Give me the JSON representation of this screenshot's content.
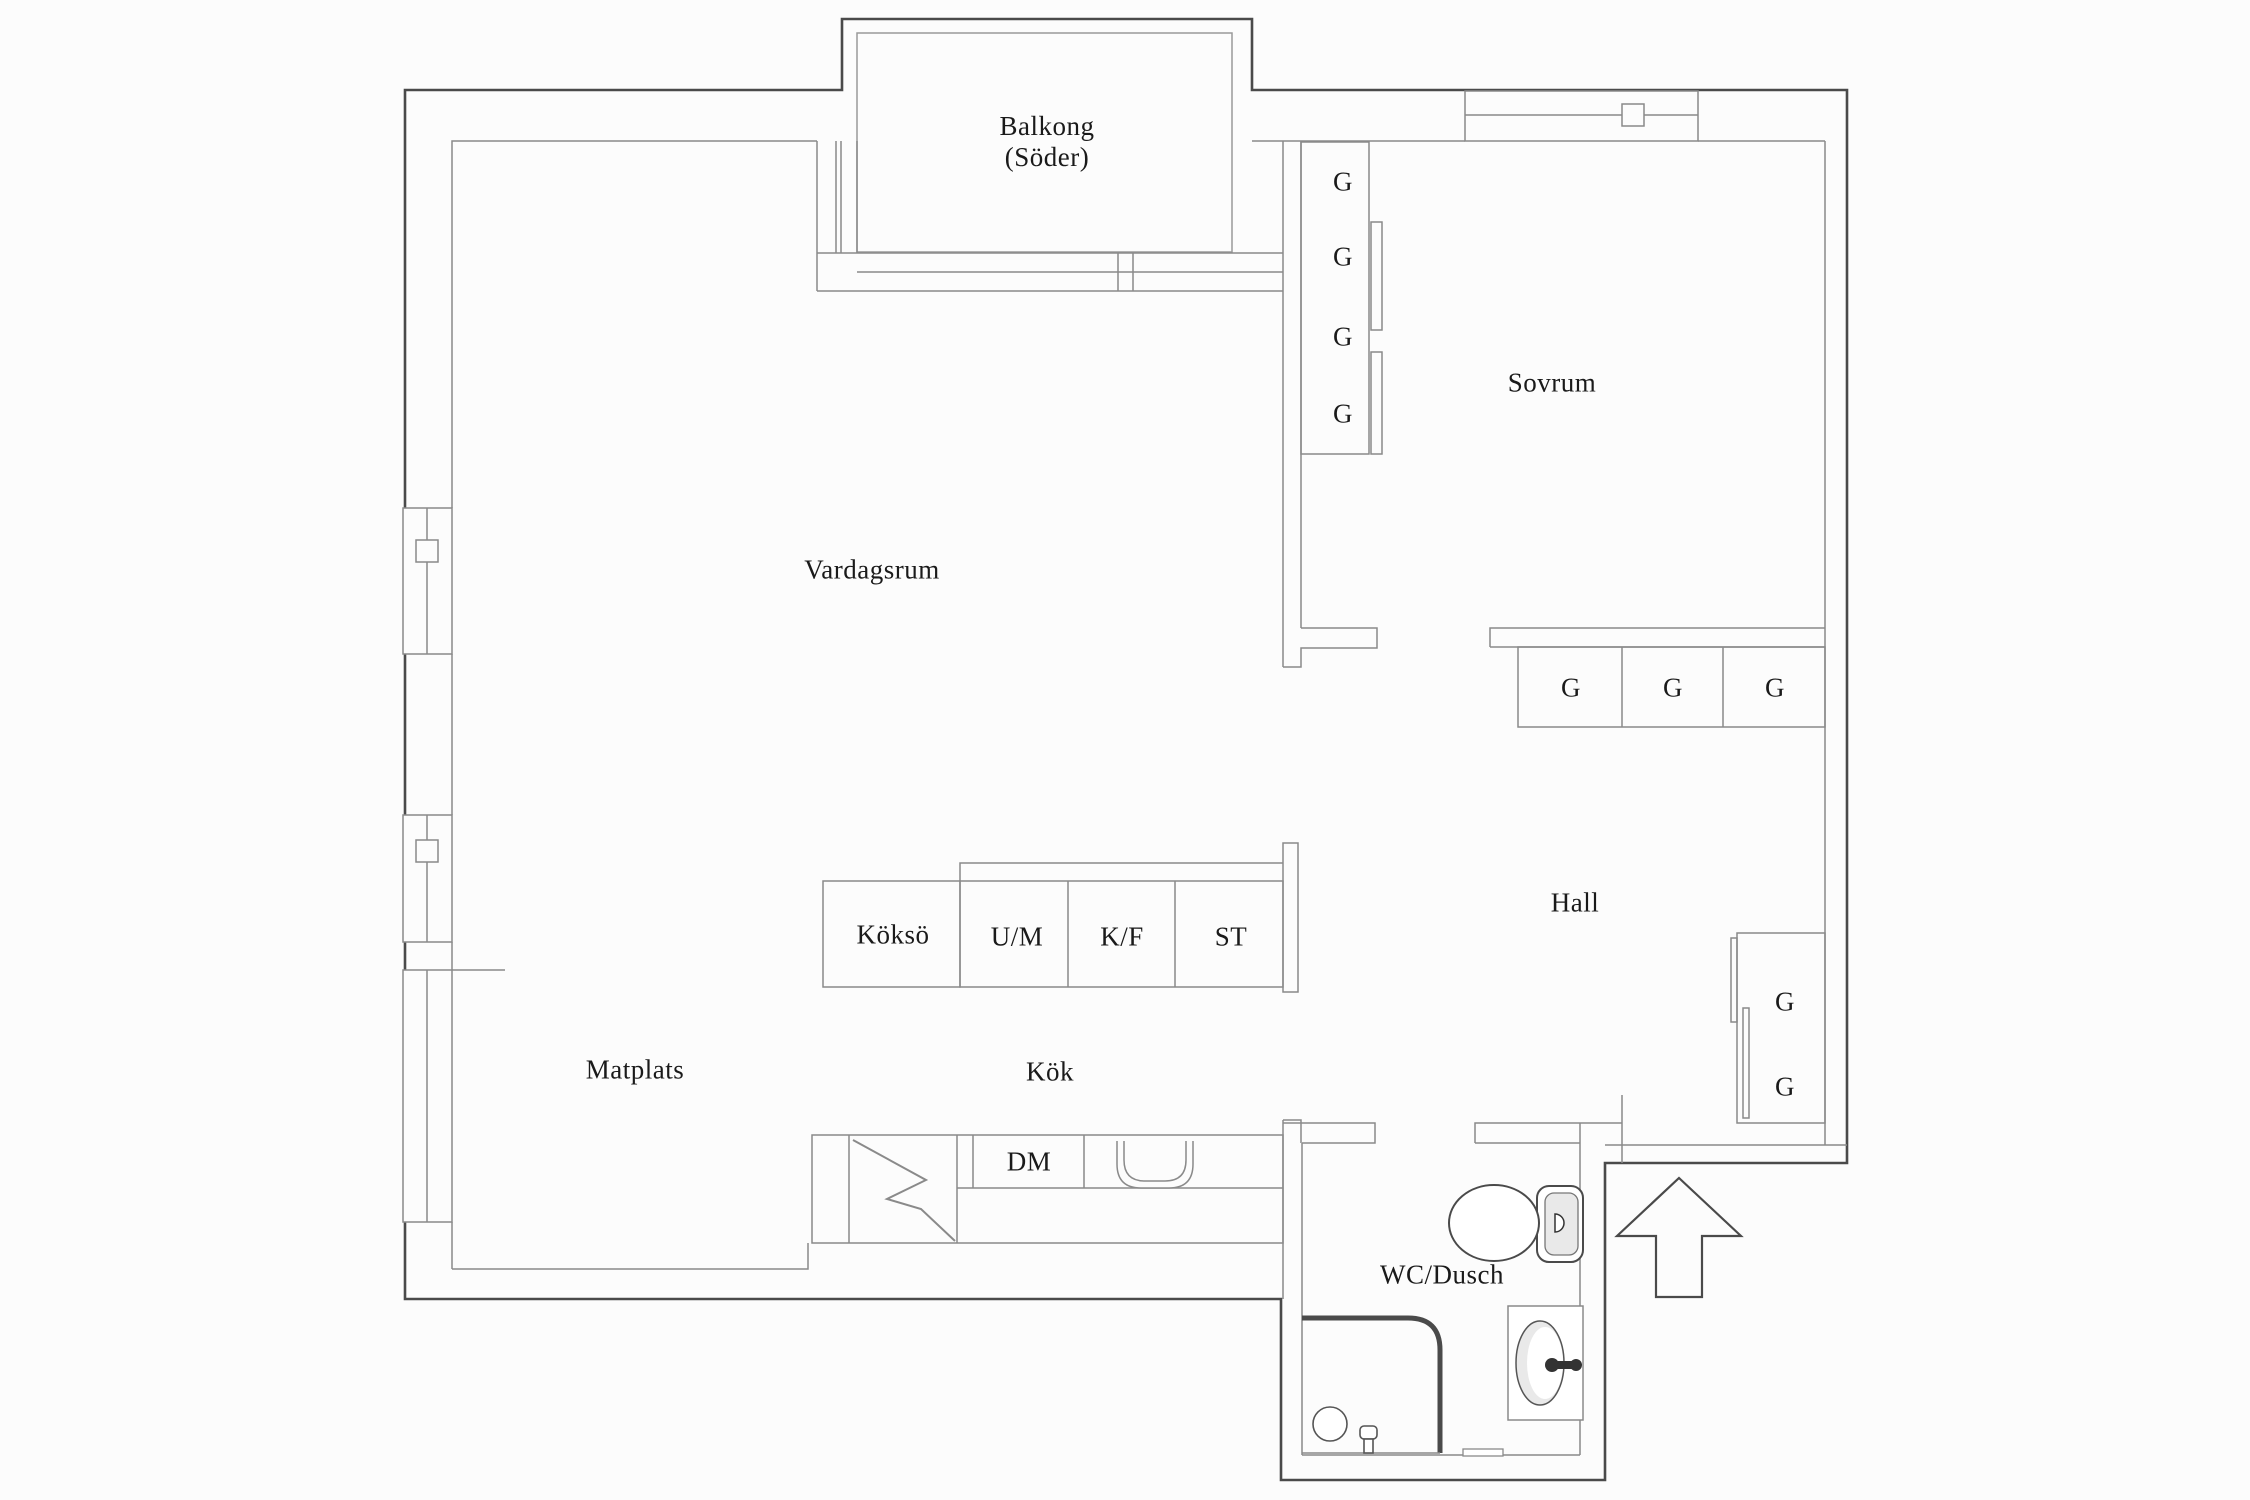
{
  "labels": {
    "balkong_line1": "Balkong",
    "balkong_line2": "(Söder)",
    "sovrum": "Sovrum",
    "vardagsrum": "Vardagsrum",
    "hall": "Hall",
    "kokso": "Köksö",
    "um": "U/M",
    "kf": "K/F",
    "st": "ST",
    "matplats": "Matplats",
    "kok": "Kök",
    "dm": "DM",
    "wc_dusch": "WC/Dusch",
    "wardrobe": "G"
  },
  "colors": {
    "background": "#fcfcfc",
    "outer_wall": "#4a4a4a",
    "inner_wall": "#8a8a8a",
    "text": "#1a1a1a",
    "fixture_fill": "#e9e9e9"
  }
}
